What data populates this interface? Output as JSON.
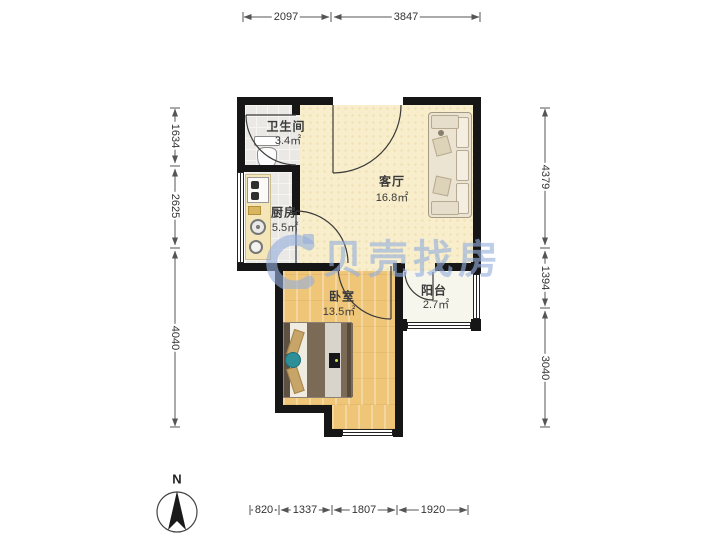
{
  "watermark": {
    "brand": "贝壳找房"
  },
  "compass": {
    "label": "N"
  },
  "rooms": [
    {
      "name": "卫生间",
      "area": "3.4㎡"
    },
    {
      "name": "厨房",
      "area": "5.5㎡"
    },
    {
      "name": "客厅",
      "area": "16.8㎡"
    },
    {
      "name": "卧室",
      "area": "13.5㎡"
    },
    {
      "name": "阳台",
      "area": "2.7㎡"
    }
  ],
  "dimensions": {
    "top": [
      "2097",
      "3847"
    ],
    "left": [
      "1634",
      "2625",
      "4040"
    ],
    "right": [
      "4379",
      "1394",
      "3040"
    ],
    "bottom": [
      "820",
      "1337",
      "1807",
      "1920"
    ]
  }
}
